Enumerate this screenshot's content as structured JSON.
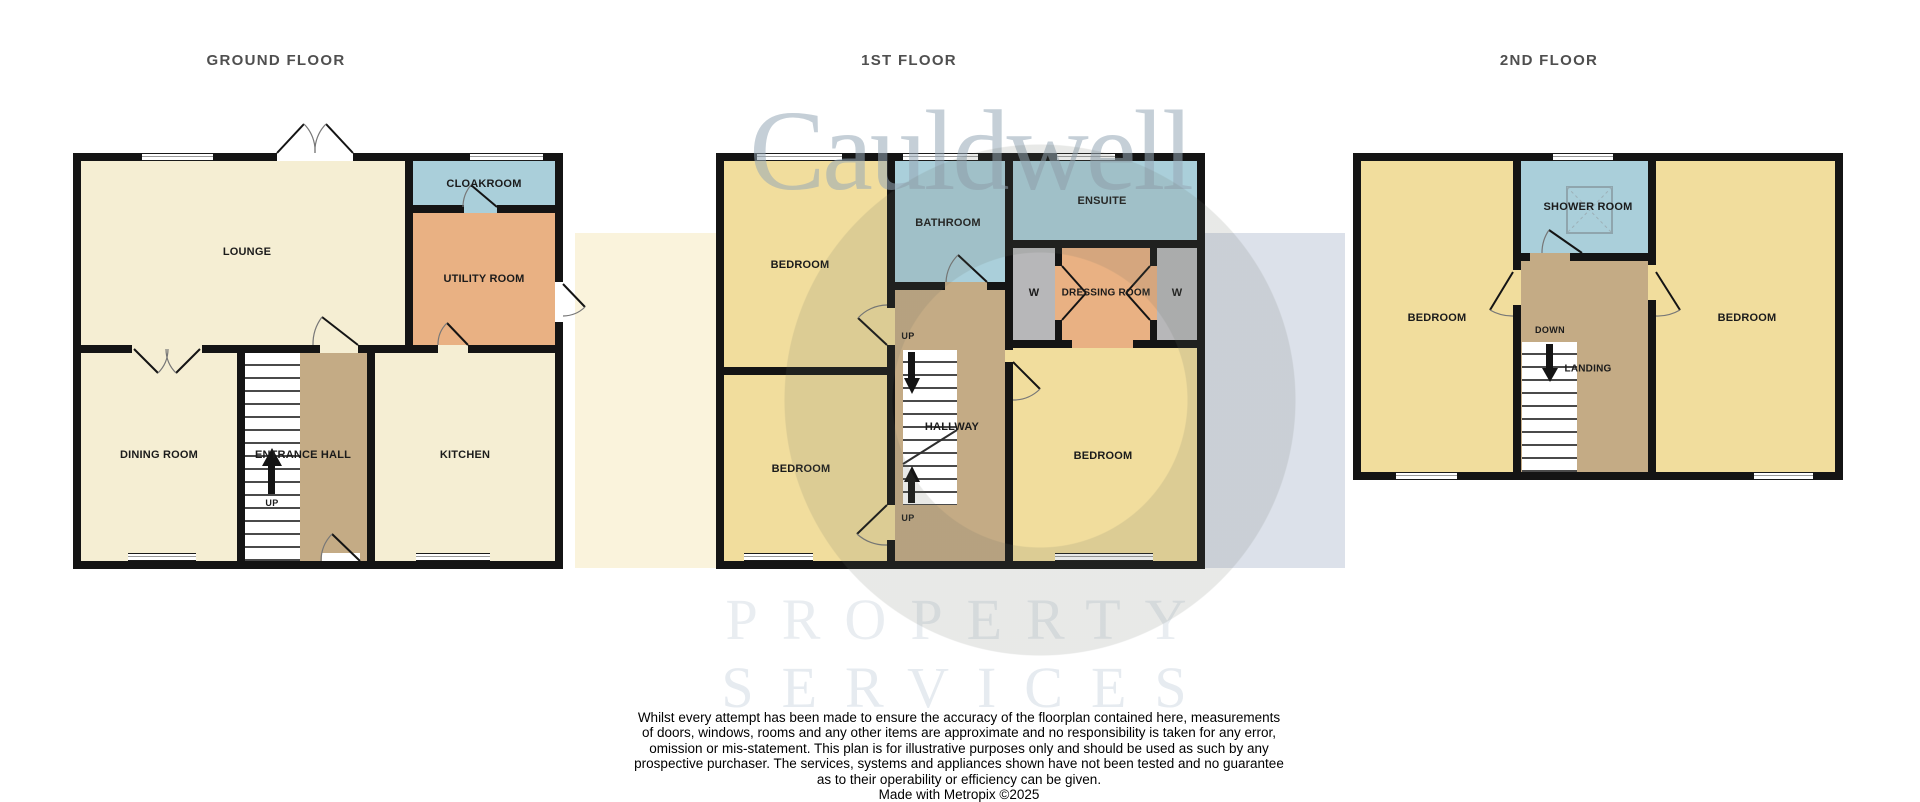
{
  "floors": {
    "ground": {
      "title": "GROUND FLOOR",
      "rooms": {
        "lounge": "LOUNGE",
        "cloakroom": "CLOAKROOM",
        "utility": "UTILITY ROOM",
        "dining": "DINING ROOM",
        "entrance_hall": "ENTRANCE HALL",
        "kitchen": "KITCHEN"
      },
      "stairs": {
        "up": "UP"
      }
    },
    "first": {
      "title": "1ST FLOOR",
      "rooms": {
        "bedroom_top_left": "BEDROOM",
        "bathroom": "BATHROOM",
        "ensuite": "ENSUITE",
        "wardrobe_left": "W",
        "dressing_room": "DRESSING ROOM",
        "wardrobe_right": "W",
        "bedroom_bottom_left": "BEDROOM",
        "hallway": "HALLWAY",
        "bedroom_right": "BEDROOM"
      },
      "stairs": {
        "up_top": "UP",
        "up_bottom": "UP"
      }
    },
    "second": {
      "title": "2ND FLOOR",
      "rooms": {
        "bedroom_left": "BEDROOM",
        "shower_room": "SHOWER ROOM",
        "bedroom_right": "BEDROOM",
        "landing": "LANDING"
      },
      "stairs": {
        "down": "DOWN"
      }
    }
  },
  "watermark": {
    "brand": "Cauldwell",
    "subtitle_line1": "PROPERTY",
    "subtitle_line2": "SERVICES"
  },
  "disclaimer": {
    "lines": [
      "Whilst every attempt has been made to ensure the accuracy of the floorplan contained here, measurements",
      "of doors, windows, rooms and any other items are approximate and no responsibility is taken for any error,",
      "omission or mis-statement. This plan is for illustrative purposes only and should be used as such by any",
      "prospective purchaser. The services, systems and appliances shown have not been tested and no guarantee",
      "as to their operability or efficiency can be given."
    ],
    "credit": "Made with Metropix ©2025"
  },
  "colors": {
    "wall": "#141414",
    "room_cream": "#f5eed3",
    "room_yellow": "#f1dd9d",
    "room_blue": "#aacfda",
    "room_orange": "#e9b183",
    "room_tan": "#c4ab85",
    "room_wardrobe": "#b7b7b9",
    "stairs": "#ffffff",
    "watermark_rect_left": "#faf3dc",
    "watermark_rect_right": "#dce1ea",
    "watermark_text": "#c8d2da",
    "watermark_words": "#e9edf1",
    "title_text": "#4f4f4f"
  }
}
